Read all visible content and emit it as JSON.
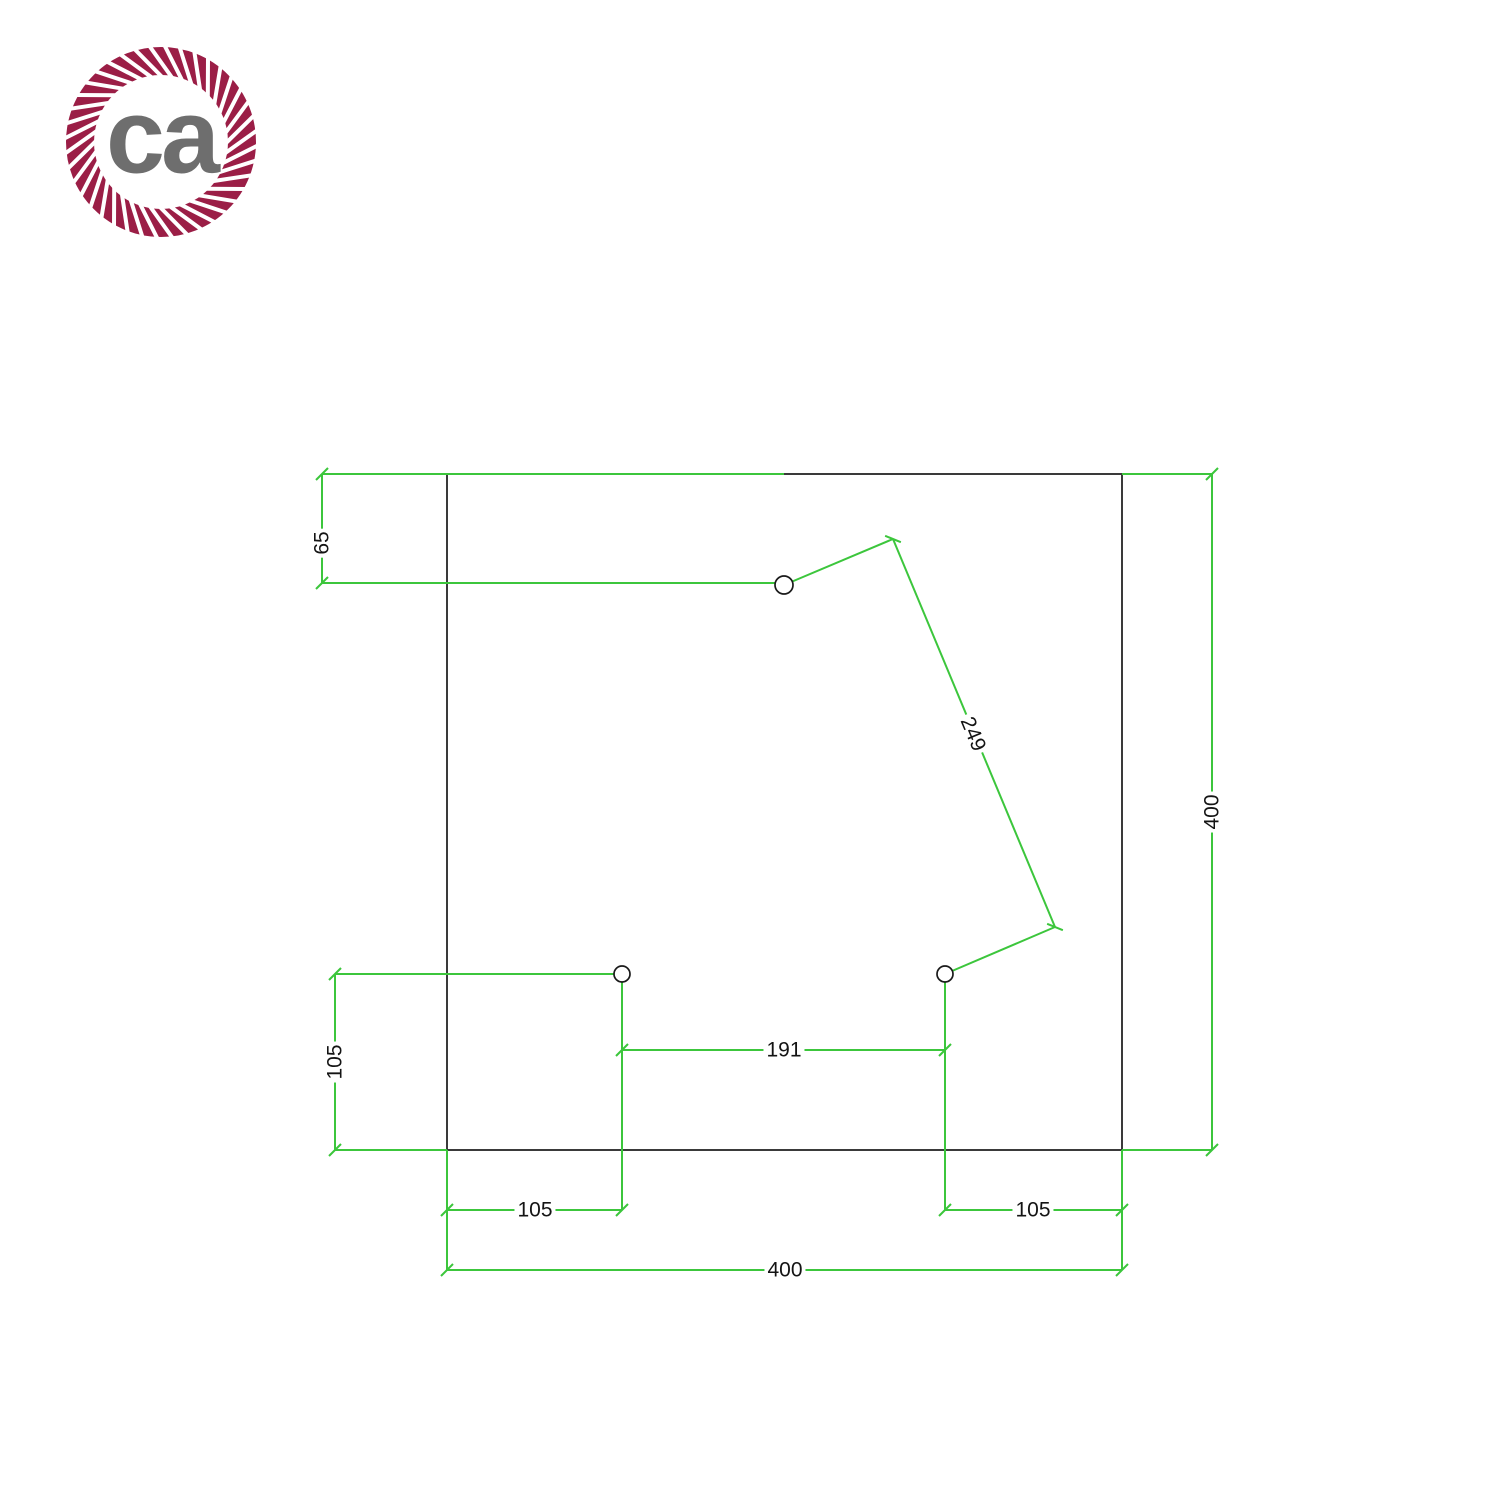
{
  "logo": {
    "text": "ca",
    "ring_color": "#9b1e46",
    "text_color": "#6e6e6e"
  },
  "drawing": {
    "type": "technical-dimension-drawing",
    "plate_shape": "square",
    "units_scale_px_per_mm": 1.6875,
    "colors": {
      "dimension_green": "#3cc63c",
      "outline_gray": "#3a3a3a",
      "label_text": "#141414"
    },
    "dimensions": {
      "top_hole_offset": "65",
      "hole_spacing_diagonal": "249",
      "plate_height": "400",
      "bottom_hole_height": "105",
      "bottom_hole_spacing": "191",
      "bottom_left_hole_offset": "105",
      "bottom_right_hole_offset": "105",
      "plate_width": "400"
    },
    "holes_count": 3
  }
}
